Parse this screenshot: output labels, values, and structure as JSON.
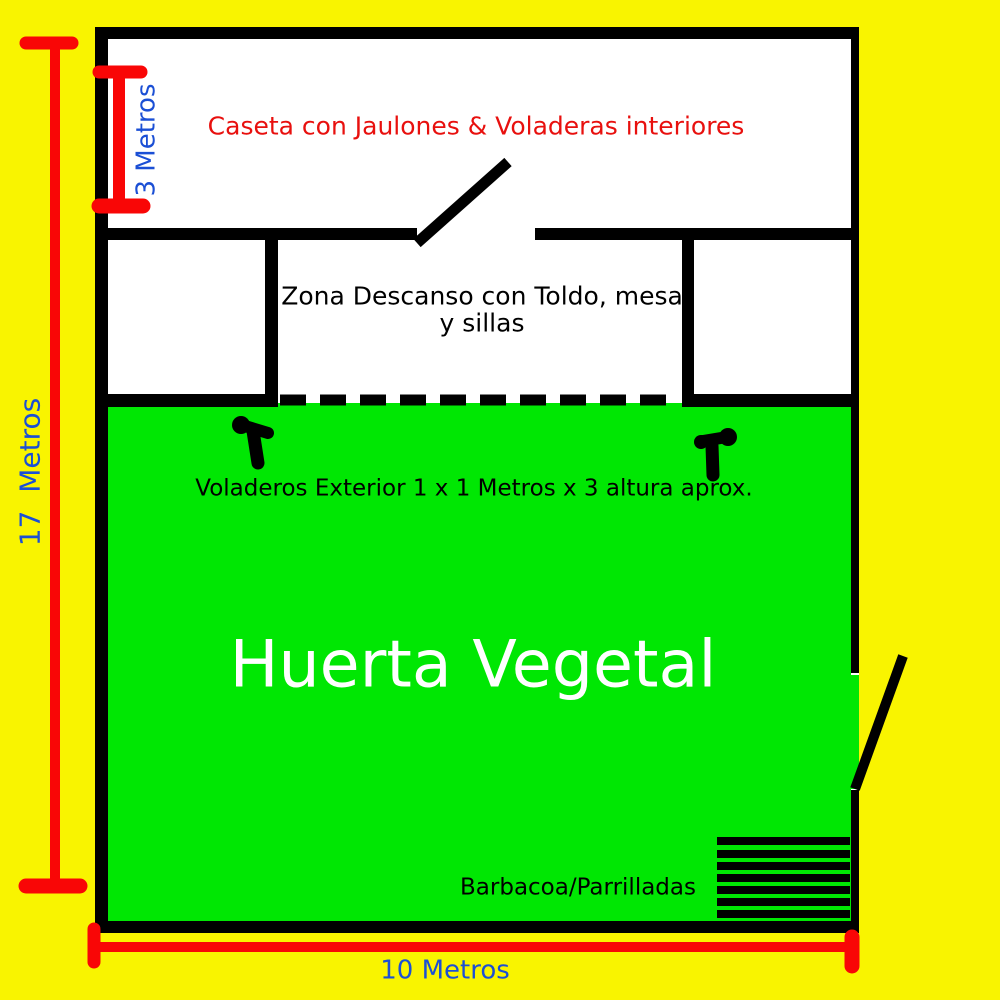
{
  "colors": {
    "background": "#F9F400",
    "garden_green": "#00E703",
    "wall_black": "#000000",
    "room_white": "#FFFFFF",
    "measure_red": "#F90606",
    "caseta_text_red": "#E8100E",
    "dimension_blue": "#1B4FD5",
    "huerta_text_white": "#FFFFFF"
  },
  "labels": {
    "caseta": "Caseta con Jaulones & Voladeras interiores",
    "zona_descanso_line1": "Zona Descanso con Toldo, mesa",
    "zona_descanso_line2": "y sillas",
    "voladeros": "Voladeros Exterior 1 x 1 Metros x 3 altura aprox.",
    "huerta": "Huerta Vegetal",
    "barbacoa": "Barbacoa/Parrilladas"
  },
  "dimensions": {
    "height_total": "17  Metros",
    "caseta_height": "3 Metros",
    "width_total": "10 Metros"
  }
}
